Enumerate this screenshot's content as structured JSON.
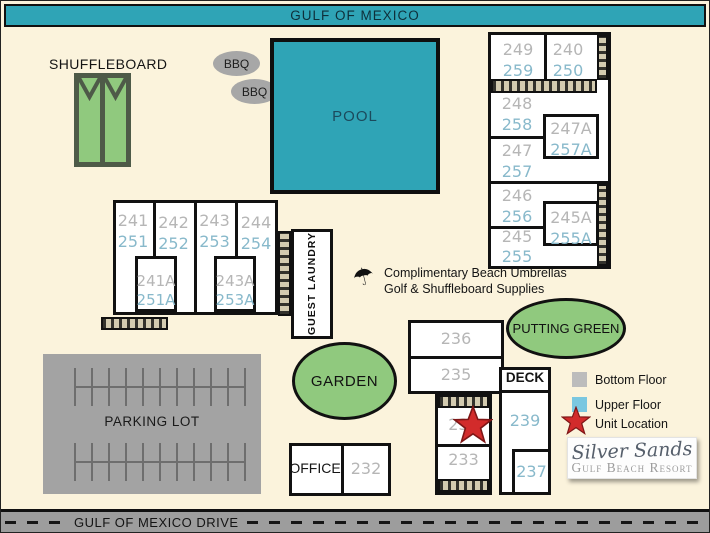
{
  "roads": {
    "top": "GULF OF MEXICO",
    "bottom": "GULF OF MEXICO DRIVE"
  },
  "features": {
    "shuffleboard": "SHUFFLEBOARD",
    "bbq": "BBQ",
    "pool": "POOL",
    "garden": "GARDEN",
    "putting_green": "PUTTING GREEN",
    "parking": "PARKING LOT",
    "office": "OFFICE",
    "guest_laundry": "GUEST LAUNDRY",
    "deck": "DECK"
  },
  "note": {
    "line1": "Complimentary Beach Umbrellas",
    "line2": "Golf & Shuffleboard Supplies"
  },
  "units": {
    "ne": [
      {
        "lower": "249",
        "upper": "259"
      },
      {
        "lower": "240",
        "upper": "250"
      },
      {
        "lower": "248",
        "upper": "258"
      },
      {
        "lower": "247A",
        "upper": "257A"
      },
      {
        "lower": "247",
        "upper": "257"
      },
      {
        "lower": "246",
        "upper": "256"
      },
      {
        "lower": "245A",
        "upper": "255A"
      },
      {
        "lower": "245",
        "upper": "255"
      }
    ],
    "west": [
      {
        "lower": "241",
        "upper": "251"
      },
      {
        "lower": "242",
        "upper": "252"
      },
      {
        "lower": "243",
        "upper": "253"
      },
      {
        "lower": "244",
        "upper": "254"
      },
      {
        "lower": "241A",
        "upper": "251A"
      },
      {
        "lower": "243A",
        "upper": "253A"
      }
    ],
    "south": {
      "u236": "236",
      "u235": "235",
      "u234": "234",
      "u233": "233",
      "u232": "232",
      "u239": "239",
      "u237": "237"
    }
  },
  "legend": {
    "items": [
      {
        "label": "Bottom Floor",
        "swatch": "gray-square"
      },
      {
        "label": "Upper Floor",
        "swatch": "teal-square"
      },
      {
        "label": "Unit Location",
        "swatch": "red-star"
      }
    ]
  },
  "logo": {
    "title": "Silver Sands",
    "subtitle": "Gulf Beach Resort"
  },
  "colors": {
    "background": "#fbf3dc",
    "water_teal": "#2fa4b6",
    "green": "#90c97e",
    "road_gray": "#9d9d9d",
    "bottom_floor_gray": "#bcbcbc",
    "upper_floor_teal": "#7ac7e0",
    "unit_gray_text": "#b6b6b6",
    "unit_teal_text": "#88b9cb",
    "star_red": "#d22b2b",
    "hatch_tan": "#d3cbb0"
  }
}
